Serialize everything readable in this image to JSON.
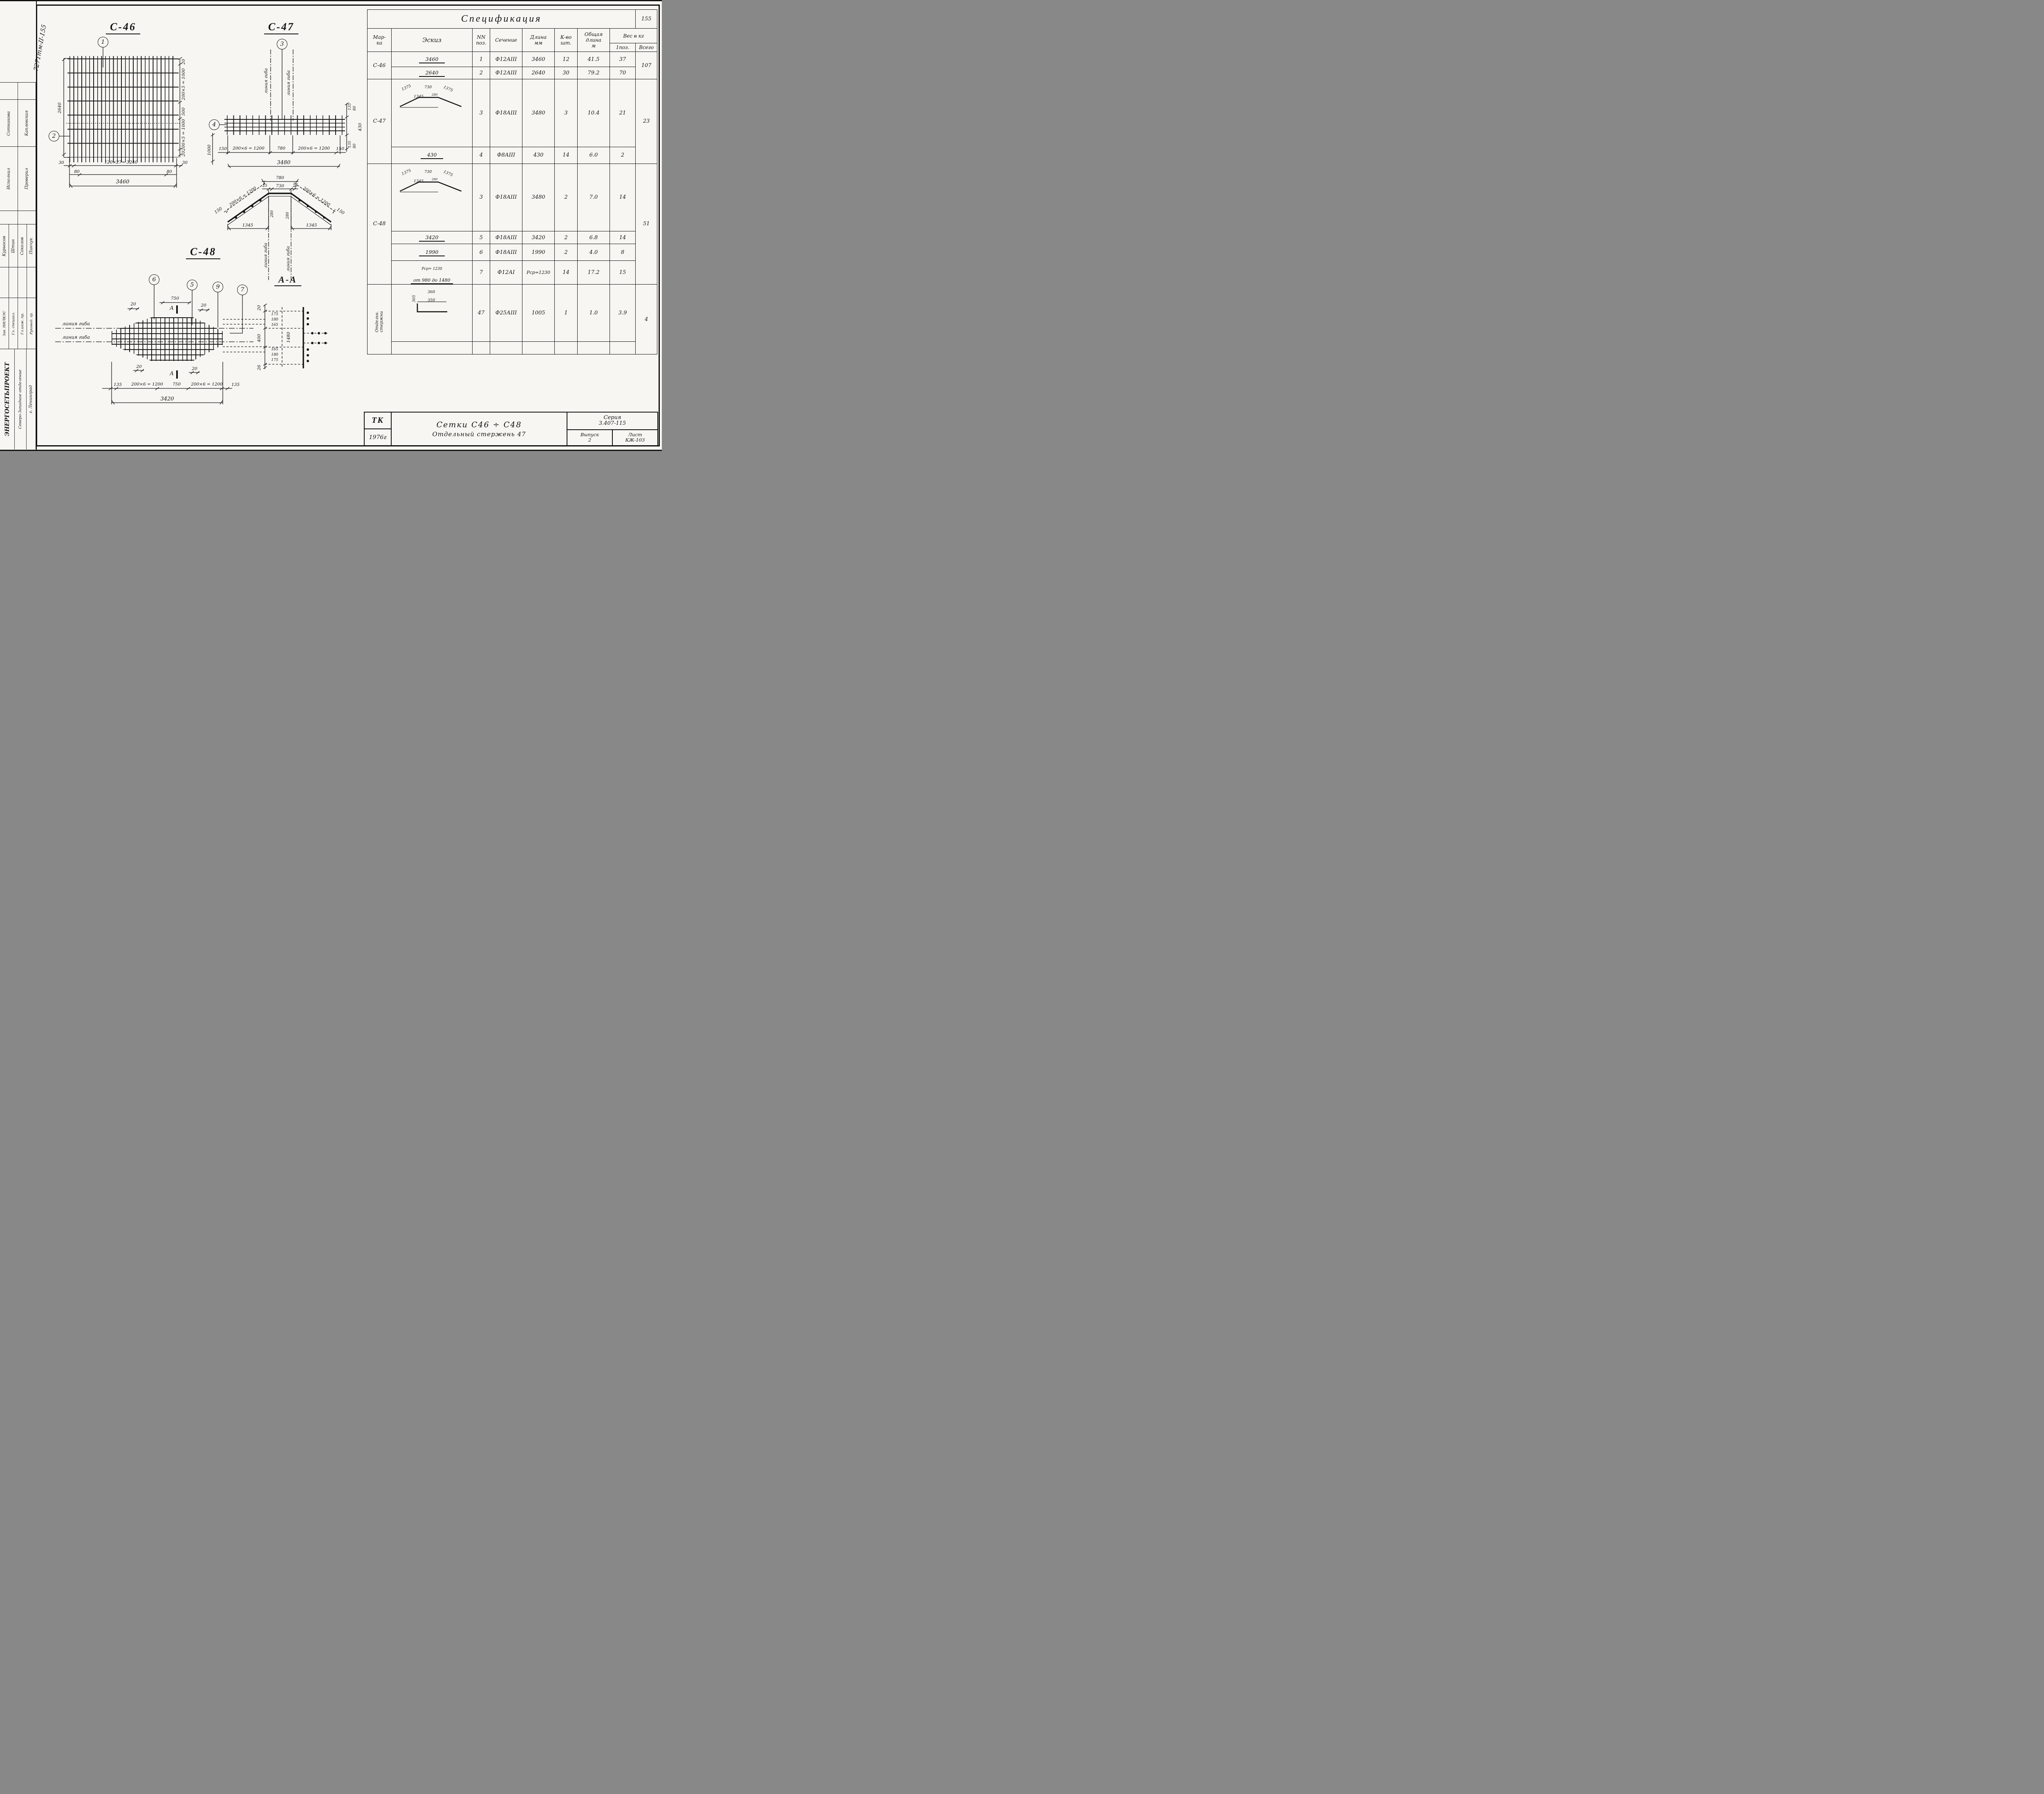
{
  "sheet": {
    "page": "155",
    "stamp": "7271тм-II-155"
  },
  "sidebar": {
    "org": {
      "name": "ЭНЕРГОСЕТЬПРОЕКТ",
      "branch": "Северо-Западное отделение",
      "city": "г. Ленинград"
    },
    "execs": [
      {
        "role": "Исполнил",
        "name": "Сотникова"
      },
      {
        "role": "Проверил",
        "name": "Каплевская"
      }
    ],
    "signers": [
      {
        "role": "Зав. НИЛКЭС",
        "name": "Курносов"
      },
      {
        "role": "Гл. специал.",
        "name": "Штин"
      },
      {
        "role": "Гл.инж. пр.",
        "name": "Соколов"
      },
      {
        "role": "Руковод. гр.",
        "name": "Пинчук"
      }
    ]
  },
  "c46": {
    "title": "С-46",
    "co1": "1",
    "co2": "2",
    "h": "2640",
    "b30l": "30",
    "bmid": "120×27= 3240",
    "b30r": "30",
    "b80l": "80",
    "b80r": "80",
    "btot": "3460",
    "r20t": "20",
    "rseg1": "200×5 = 1000",
    "r500": "500",
    "rseg2": "200×5 = 1000",
    "r20b": "20"
  },
  "c47": {
    "title": "С-47",
    "bend": "линия гиба",
    "co3": "3",
    "co4": "4",
    "r135t": "135",
    "r80t": "80",
    "r430": "430",
    "r135b": "135",
    "r80b": "80",
    "l1000": "1000",
    "b150l": "150",
    "bseg1": "200×6 = 1200",
    "b780": "780",
    "bseg2": "200×6 = 1200",
    "b150r": "150",
    "btot": "3480",
    "d780": "780",
    "d25l": "25",
    "d730": "730",
    "d25r": "25",
    "dslantl": "200×6 = 1200",
    "d150l": "150",
    "dslantr": "200×6 = 1200",
    "d150r": "150",
    "d1345l": "1345",
    "d280l": "280",
    "d280r": "280",
    "d1345r": "1345"
  },
  "c48": {
    "title": "С-48",
    "co6": "6",
    "co5": "5",
    "co9": "9",
    "co7": "7",
    "t750": "750",
    "sec": "А",
    "t20l": "20",
    "t20r": "20",
    "bend": "линия гиба",
    "b20l": "20",
    "b20r": "20",
    "b135l": "135",
    "bseg1": "200×6 = 1200",
    "b750": "750",
    "bseg2": "200×6 = 1200",
    "b135r": "135",
    "btot": "3420"
  },
  "aa": {
    "title": "А-А",
    "c20": "20",
    "s175a": "175",
    "s180a": "180",
    "s165a": "165",
    "c400": "400",
    "s165b": "165",
    "s180b": "180",
    "s175b": "175",
    "c26": "26",
    "inner": "1480"
  },
  "table": {
    "title": "Спецификация",
    "h": {
      "mark": "Мар-\nка",
      "sketch": "Эскиз",
      "nn": "NN\nпоз.",
      "sec": "Сечение",
      "len": "Длина\nмм",
      "qty": "К-во\nшт.",
      "tlen": "Общая\nдлина\nм",
      "weight": "Вес в кг",
      "w1": "1поз.",
      "wt": "Всего"
    },
    "g46": {
      "mark": "С-46",
      "total": "107"
    },
    "g47": {
      "mark": "С-47",
      "total": "23"
    },
    "g48": {
      "mark": "С-48",
      "total": "51"
    },
    "gsep": {
      "mark": "Отдельн.\nстержни",
      "total": "4"
    },
    "trap": {
      "l": "1375",
      "top": "730",
      "r": "1375",
      "base": "1345",
      "rise": "280"
    },
    "rows": [
      {
        "sk": "3460",
        "pos": "1",
        "sec": "Ф12АIII",
        "len": "3460",
        "qty": "12",
        "tlen": "41.5",
        "w": "37"
      },
      {
        "sk": "2640",
        "pos": "2",
        "sec": "Ф12АIII",
        "len": "2640",
        "qty": "30",
        "tlen": "79.2",
        "w": "70"
      },
      {
        "pos": "3",
        "sec": "Ф18АIII",
        "len": "3480",
        "qty": "3",
        "tlen": "10.4",
        "w": "21"
      },
      {
        "sk": "430",
        "pos": "4",
        "sec": "Ф8АIII",
        "len": "430",
        "qty": "14",
        "tlen": "6.0",
        "w": "2"
      },
      {
        "pos": "3",
        "sec": "Ф18АIII",
        "len": "3480",
        "qty": "2",
        "tlen": "7.0",
        "w": "14"
      },
      {
        "sk": "3420",
        "pos": "5",
        "sec": "Ф18АIII",
        "len": "3420",
        "qty": "2",
        "tlen": "6.8",
        "w": "14"
      },
      {
        "sk": "1990",
        "pos": "6",
        "sec": "Ф18АIII",
        "len": "1990",
        "qty": "2",
        "tlen": "4.0",
        "w": "8"
      },
      {
        "sk": "от 980 до 1480",
        "sk2": "Рср= 1230",
        "pos": "7",
        "sec": "Ф12АI",
        "len": "Рср=1230",
        "qty": "14",
        "tlen": "17.2",
        "w": "15"
      },
      {
        "sk360": "360",
        "sk305": "305",
        "sk350": "350",
        "pos": "47",
        "sec": "Ф25АIII",
        "len": "1005",
        "qty": "1",
        "tlen": "1.0",
        "w": "3.9"
      }
    ]
  },
  "tb": {
    "code": "ТК",
    "year": "1976г",
    "t1": "Сетки С46 ÷ С48",
    "t2": "Отдельный стержень 47",
    "series_l": "Серия",
    "series": "3.407-115",
    "issue_l": "Выпуск",
    "issue": "2",
    "sheet_l": "Лист",
    "sheet": "КЖ-103"
  }
}
